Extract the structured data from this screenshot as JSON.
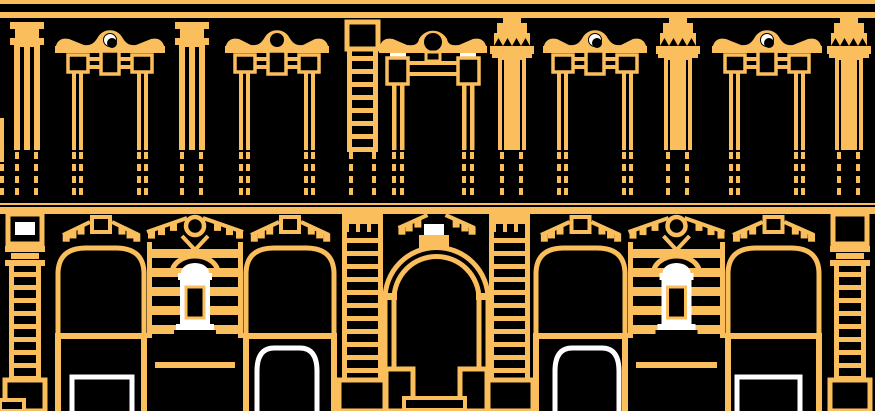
{
  "canvas": {
    "width": 875,
    "height": 411
  },
  "colors": {
    "line": "#FBBE5C",
    "highlight": "#FFFFFF",
    "background": "#000000"
  },
  "illustration": {
    "name": "classical-building-facade-elevation",
    "cornice_bands": [
      {
        "y": 0,
        "h": 4
      },
      {
        "y": 12,
        "h": 6
      }
    ],
    "upper_floor": {
      "windows": [
        {
          "cx": 110,
          "w": 110,
          "size": "s",
          "oculus": "white"
        },
        {
          "cx": 277,
          "w": 104,
          "size": "s",
          "oculus": "dark"
        },
        {
          "cx": 433,
          "w": 108,
          "size": "l",
          "oculus": "dark"
        },
        {
          "cx": 595,
          "w": 104,
          "size": "s",
          "oculus": "white"
        },
        {
          "cx": 767,
          "w": 110,
          "size": "s",
          "oculus": "white"
        }
      ],
      "pilasters": [
        {
          "cx": 27,
          "style": "pilaster"
        },
        {
          "cx": 192,
          "style": "pilaster"
        },
        {
          "cx": 512,
          "style": "column"
        },
        {
          "cx": 678,
          "style": "column"
        },
        {
          "cx": 849,
          "style": "column"
        }
      ],
      "quoin_strip": {
        "x": 347,
        "w": 31,
        "top": 22,
        "bottom": 150
      },
      "left_sliver": {
        "x": 0,
        "y": 118,
        "w": 4,
        "h": 44
      }
    },
    "balcony": {
      "top": 150,
      "bottom": 202,
      "bar_w": 4,
      "seg_h": 7,
      "seg_step": 12
    },
    "string_course": {
      "thin_y": 203,
      "thin_h": 2,
      "band_y": 207,
      "band_h": 7
    },
    "ground_floor": {
      "edge_pilasters": [
        {
          "x": 5,
          "w": 40,
          "white_cap": true
        },
        {
          "x": 830,
          "w": 40,
          "white_cap": false
        }
      ],
      "striped_piers": [
        {
          "x": 147,
          "w": 96
        },
        {
          "x": 628,
          "w": 97
        }
      ],
      "quoin_piers": [
        {
          "x": 342,
          "w": 41
        },
        {
          "x": 489,
          "w": 41
        }
      ],
      "arch_bays": [
        {
          "x1": 55,
          "x2": 147,
          "frame": "rect",
          "fx": 72,
          "fw": 60
        },
        {
          "x1": 243,
          "x2": 337,
          "frame": "arch",
          "fx": 257,
          "fw": 60
        },
        {
          "x1": 533,
          "x2": 628,
          "frame": "arch",
          "fx": 555,
          "fw": 64
        },
        {
          "x1": 725,
          "x2": 822,
          "frame": "rect",
          "fx": 737,
          "fw": 63
        }
      ],
      "central_door": {
        "x1": 383,
        "x2": 490,
        "arch_cy": 299,
        "r_outer": 51.5,
        "r_inner": 42.5,
        "keystone": {
          "x": 424,
          "w": 20
        },
        "step": {
          "x": 404,
          "y": 398,
          "w": 61,
          "h": 12
        }
      },
      "storefront": {
        "beam_y": 333,
        "beam_h": 6,
        "transom_y": 362,
        "rect_frame_top": 377,
        "arch_frame_top": 348
      },
      "left_step": {
        "x": 0,
        "y": 400,
        "w": 24,
        "h": 11
      }
    }
  }
}
